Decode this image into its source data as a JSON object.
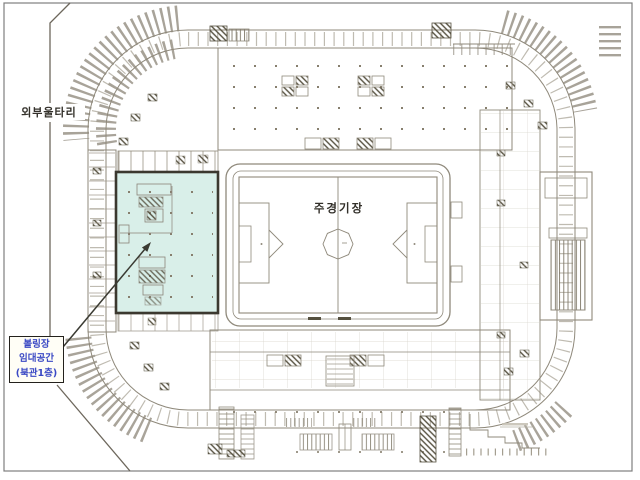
{
  "page": {
    "kind": "scanned stadium floor plan",
    "background": "#ffffff",
    "frame_color": "#7e7e7e",
    "ink_color": "#8f897b"
  },
  "labels": {
    "fence": "외부울타리",
    "stadium": "주경기장",
    "callout_lines": [
      "볼링장",
      "임대공간",
      "(북관1층)"
    ]
  },
  "callout": {
    "text_color": "#3a49c4",
    "border_color": "#23211c",
    "background": "#fffef6",
    "full_text": "볼링장 임대공간 (북관1층)"
  },
  "highlight": {
    "fill": "#d9efe9",
    "border": "#3b382f",
    "refers_to": "볼링장 임대공간 (북관1층)"
  }
}
